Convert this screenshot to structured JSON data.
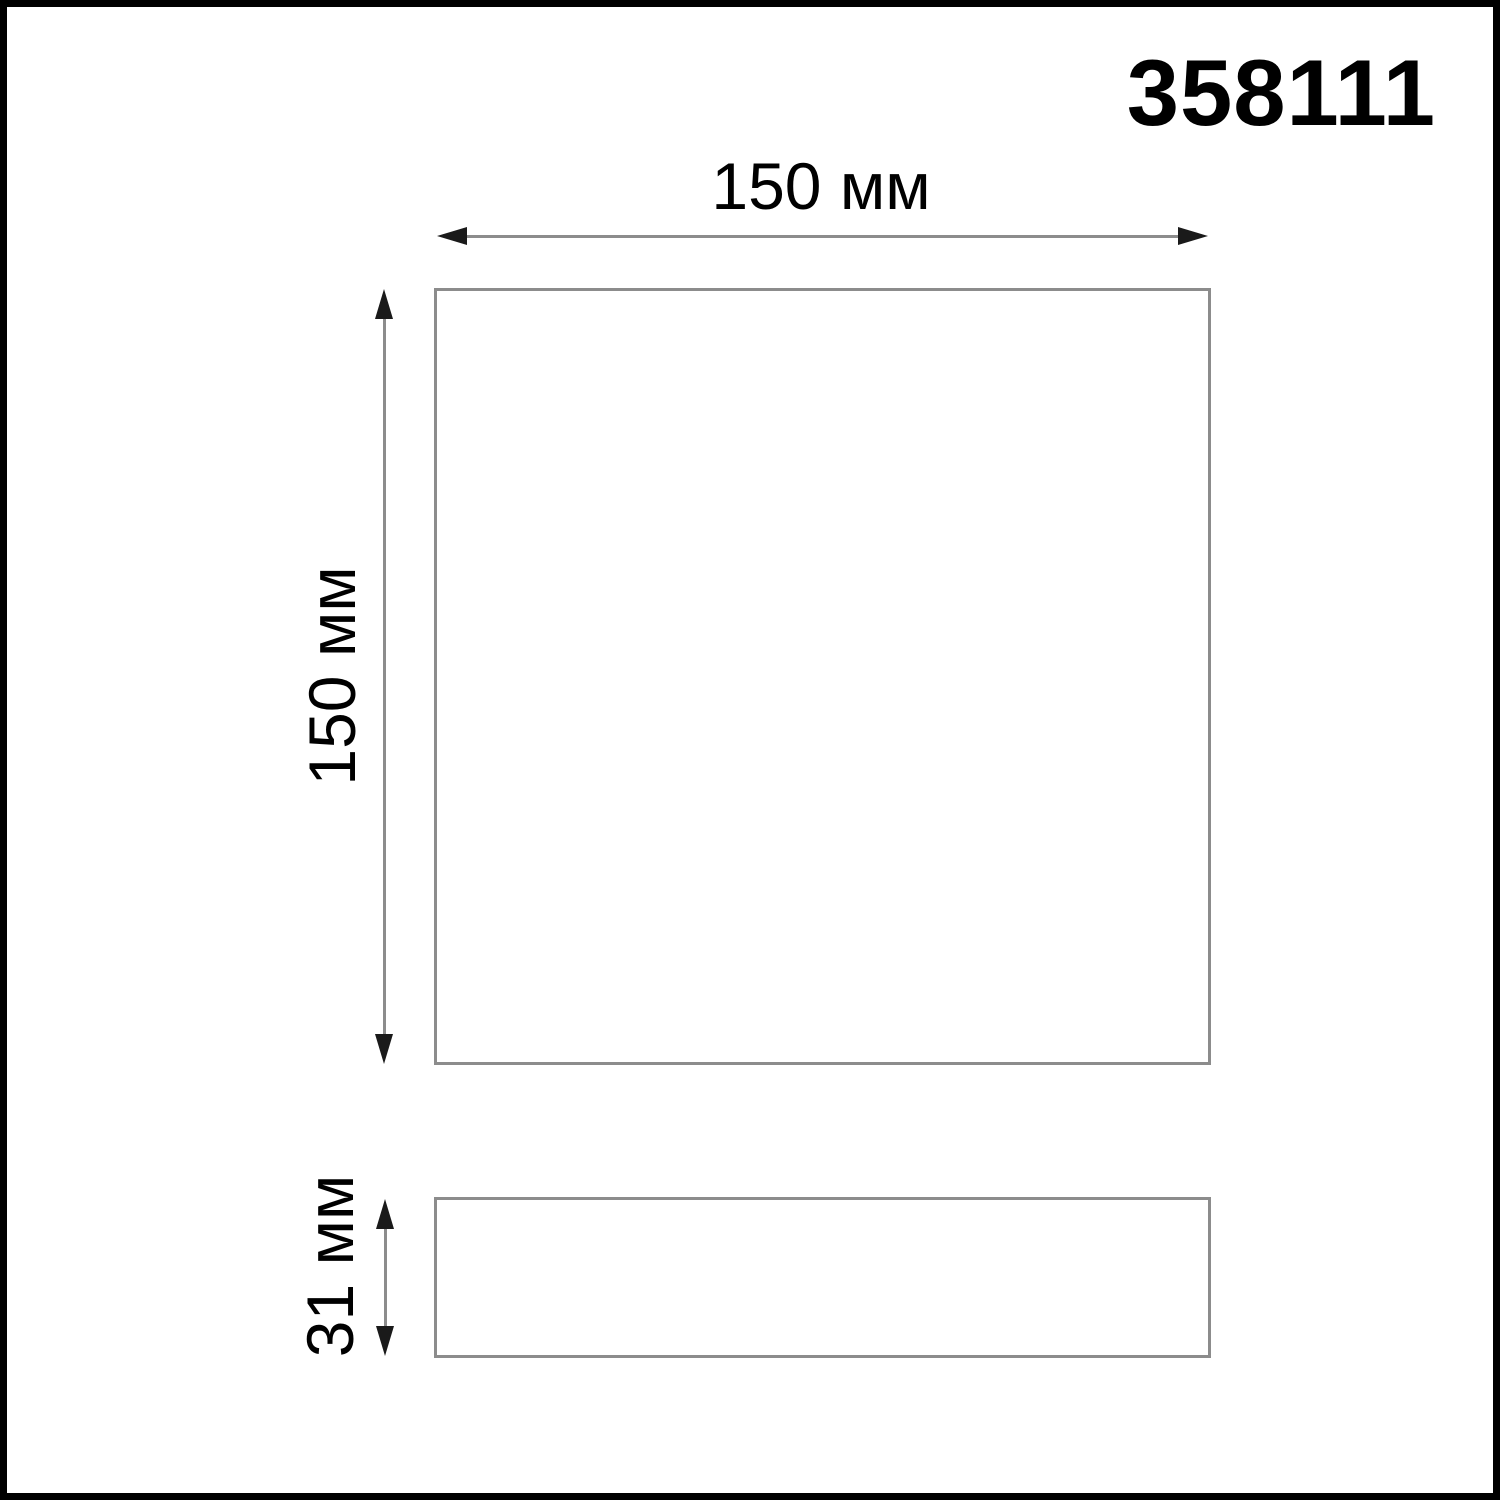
{
  "product_code": "358111",
  "views": {
    "front": {
      "width_label": "150 мм",
      "height_label": "150 мм"
    },
    "side": {
      "depth_label": "31 мм"
    }
  },
  "colors": {
    "frame": "#000000",
    "stroke": "#8c8c8c",
    "dimline": "#8c8c8c",
    "arrow": "#1a1a1a",
    "text": "#000000",
    "background": "#ffffff"
  }
}
